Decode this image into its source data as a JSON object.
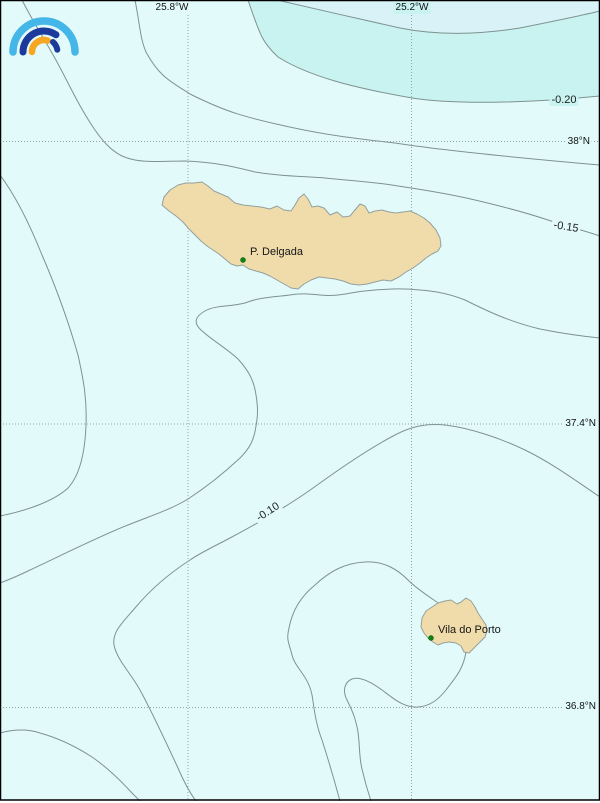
{
  "map": {
    "top_ticks": [
      {
        "label": "25.8°W"
      },
      {
        "label": "25.2°W"
      }
    ],
    "lat_ticks": [
      {
        "label": "38°N"
      },
      {
        "label": "37.4°N"
      },
      {
        "label": "36.8°N"
      }
    ],
    "contour_labels": [
      {
        "value": "-0.20"
      },
      {
        "value": "-0.15"
      },
      {
        "value": "-0.10"
      }
    ],
    "places": [
      {
        "name": "P. Delgada"
      },
      {
        "name": "Vila do Porto"
      }
    ],
    "map_data": {
      "type": "contour-map",
      "region": "Azores (São Miguel and Santa Maria islands)",
      "lon_gridlines_deg_w": [
        25.8,
        25.2
      ],
      "lat_gridlines_deg_n": [
        38.0,
        37.4,
        36.8
      ],
      "contour_levels_labeled": [
        -0.2,
        -0.15,
        -0.1
      ],
      "grid": "dotted"
    },
    "colors": {
      "sea_base": "#e2fbfa",
      "sea_band_upper_right": "#c9f3f0",
      "sea_corner_top_right": "#d8f2f8",
      "contour_line": "#7e928f",
      "grid_dots": "#8fa6a4",
      "island_fill": "#f0dcab",
      "island_border": "#93a09e",
      "city_marker_green": "#0c860c",
      "frame": "#000000",
      "logo_light_blue": "#45b6e8",
      "logo_dark_blue": "#1c3a9b",
      "logo_orange": "#f7a623"
    }
  }
}
